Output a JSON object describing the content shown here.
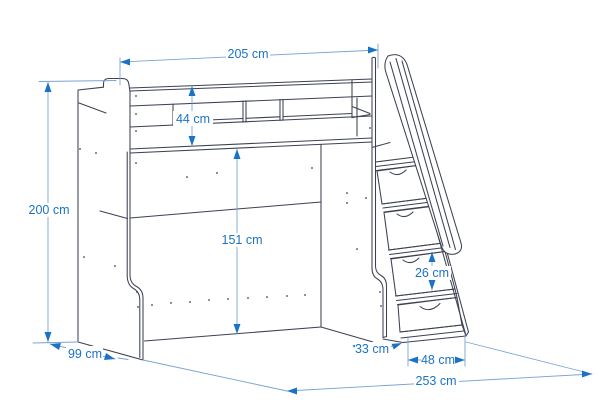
{
  "diagram": {
    "type": "furniture-dimension-drawing",
    "subject": "loft bed with guard rail and storage stairs",
    "unit": "cm",
    "colors": {
      "outline": "#3d4152",
      "dimension_accent": "#1a73c6",
      "dimension_line": "#7aa3d4",
      "background": "#ffffff"
    },
    "dimensions": {
      "bed_length": {
        "label": "205 cm",
        "value": 205
      },
      "guard_rail_height": {
        "label": "44 cm",
        "value": 44
      },
      "total_height": {
        "label": "200 cm",
        "value": 200
      },
      "under_bed_clearance": {
        "label": "151 cm",
        "value": 151
      },
      "step_rise": {
        "label": "26 cm",
        "value": 26
      },
      "stairs_offset": {
        "label": "33 cm",
        "value": 33
      },
      "stairs_width": {
        "label": "48 cm",
        "value": 48
      },
      "bed_depth": {
        "label": "99 cm",
        "value": 99
      },
      "total_length": {
        "label": "253 cm",
        "value": 253
      }
    }
  }
}
